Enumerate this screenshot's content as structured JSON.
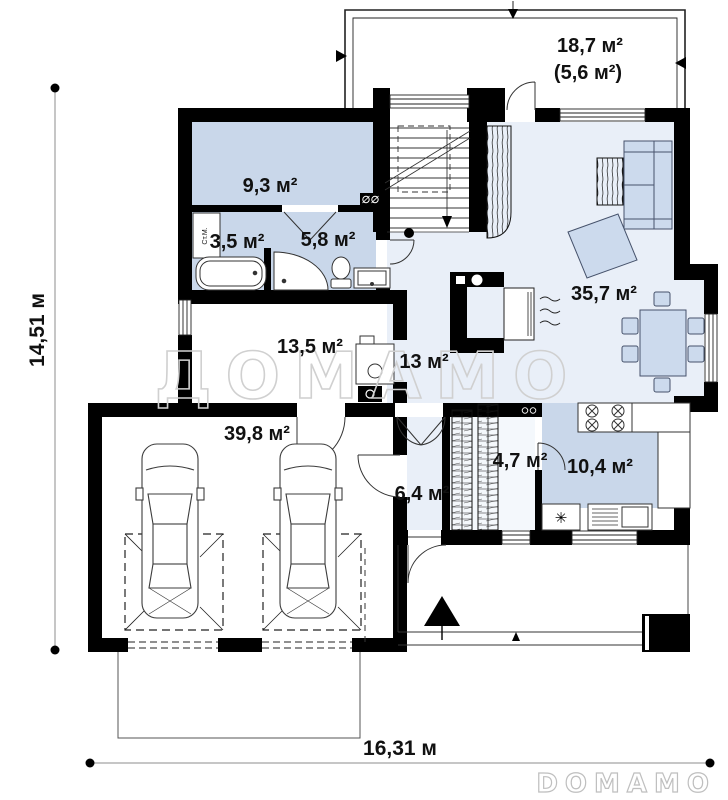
{
  "plan": {
    "watermark": "ДОМАМО",
    "brand_logo": "DOMAMO",
    "dimensions": {
      "width": "16,31 м",
      "depth": "14,51 м"
    },
    "rooms": [
      {
        "id": "terrace",
        "label": "18,7 м²",
        "sublabel": "(5,6 м²)"
      },
      {
        "id": "bedroom",
        "label": "9,3 м²"
      },
      {
        "id": "bathroom",
        "label": "3,5 м²"
      },
      {
        "id": "shower-room",
        "label": "5,8 м²"
      },
      {
        "id": "boiler-room",
        "label": "13,5 м²"
      },
      {
        "id": "hall",
        "label": "13 м²"
      },
      {
        "id": "living-room",
        "label": "35,7 м²"
      },
      {
        "id": "garage",
        "label": "39,8 м²"
      },
      {
        "id": "entry",
        "label": "6,4 м²"
      },
      {
        "id": "wardrobe",
        "label": "4,7 м²"
      },
      {
        "id": "kitchen",
        "label": "10,4 м²"
      }
    ],
    "fixtures": {
      "washing_machine": "Ст.М.",
      "sink_symbol": "✳"
    },
    "colors": {
      "wall": "#000000",
      "room_blue": "#c9d7ea",
      "floor_light": "#e9eff8",
      "furniture_blue": "#ccdaed",
      "wardrobe_bg": "#f4f8fc",
      "watermark_gray": "#d0d0d0",
      "logo_gray": "#bfbfbf"
    }
  }
}
